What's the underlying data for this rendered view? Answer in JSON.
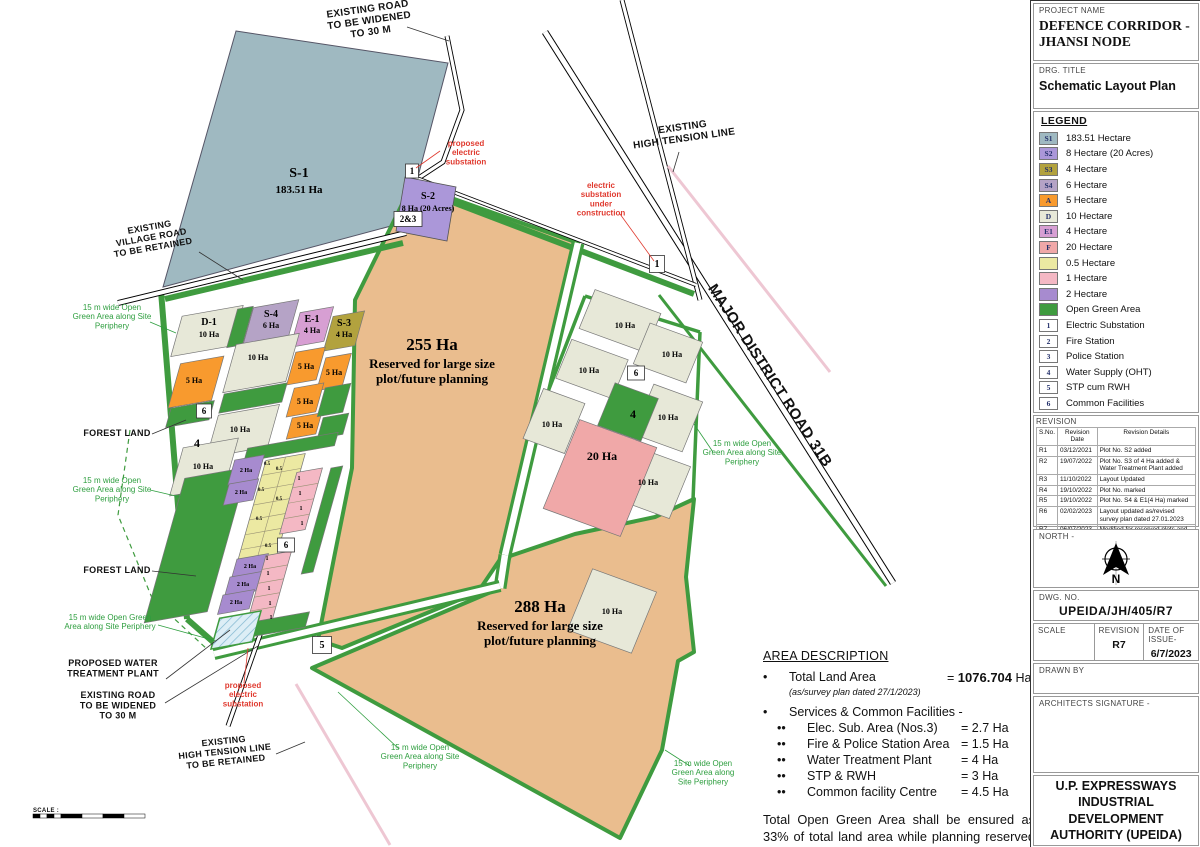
{
  "title_block": {
    "project_name_label": "PROJECT NAME",
    "project_name": "DEFENCE CORRIDOR -\nJHANSI NODE",
    "drg_title_label": "DRG. TITLE",
    "drg_title": "Schematic Layout Plan",
    "legend": {
      "heading": "LEGEND",
      "items": [
        {
          "key": "S1",
          "color": "#9fb9c1",
          "label": "183.51 Hectare",
          "type": "swatch"
        },
        {
          "key": "S2",
          "color": "#ab97d9",
          "label": "8 Hectare (20 Acres)",
          "type": "swatch"
        },
        {
          "key": "S3",
          "color": "#b2a23e",
          "label": "4 Hectare",
          "type": "swatch"
        },
        {
          "key": "S4",
          "color": "#b5a3c6",
          "label": "6 Hectare",
          "type": "swatch"
        },
        {
          "key": "A",
          "color": "#f89a2e",
          "label": "5 Hectare",
          "type": "swatch"
        },
        {
          "key": "D",
          "color": "#e7e8d8",
          "label": "10 Hectare",
          "type": "swatch"
        },
        {
          "key": "E1",
          "color": "#d79fd3",
          "label": "4 Hectare",
          "type": "swatch"
        },
        {
          "key": "F",
          "color": "#f0a8a8",
          "label": "20 Hectare",
          "type": "swatch"
        },
        {
          "key": "",
          "color": "#ece9a2",
          "label": "0.5 Hectare",
          "type": "swatch"
        },
        {
          "key": "",
          "color": "#f4b8c4",
          "label": "1 Hectare",
          "type": "swatch"
        },
        {
          "key": "",
          "color": "#a78bcf",
          "label": "2 Hectare",
          "type": "swatch"
        },
        {
          "key": "",
          "color": "#3f9b3f",
          "label": "Open Green Area",
          "type": "swatch"
        },
        {
          "key": "1",
          "color": "",
          "label": "Electric Substation",
          "type": "numbox"
        },
        {
          "key": "2",
          "color": "",
          "label": "Fire Station",
          "type": "numbox"
        },
        {
          "key": "3",
          "color": "",
          "label": "Police Station",
          "type": "numbox"
        },
        {
          "key": "4",
          "color": "",
          "label": "Water Supply (OHT)",
          "type": "numbox"
        },
        {
          "key": "5",
          "color": "",
          "label": "STP cum RWH",
          "type": "numbox"
        },
        {
          "key": "6",
          "color": "",
          "label": "Common Facilities",
          "type": "numbox"
        }
      ]
    },
    "revision": {
      "heading": "REVISION",
      "columns": [
        "S.No.",
        "Revision Date",
        "Revision Details"
      ],
      "rows": [
        [
          "R1",
          "03/12/2021",
          "Plot No. S2 added"
        ],
        [
          "R2",
          "19/07/2022",
          "Plot No. S3 of 4 Ha added & Water Treatment Plant added"
        ],
        [
          "R3",
          "11/10/2022",
          "Layout Updated"
        ],
        [
          "R4",
          "19/10/2022",
          "Plot No. marked"
        ],
        [
          "R5",
          "19/10/2022",
          "Plot No. S4 & E1(4 Ha) marked"
        ],
        [
          "R6",
          "02/02/2023",
          "Layout updated as/revised survey plan dated 27.01.2023"
        ],
        [
          "R7",
          "06/07/2023",
          "Modified for reserved plots and addition of plots of 0.5 Ha, 1 Ha, 2 Ha & 5 Ha"
        ]
      ]
    },
    "north_label": "NORTH -",
    "north_letter": "N",
    "dwg_no_label": "DWG. NO.",
    "dwg_no": "UPEIDA/JH/405/R7",
    "scale_label": "SCALE",
    "revision_label": "REVISION",
    "revision_value": "R7",
    "date_label": "DATE OF ISSUE-",
    "date_value": "6/7/2023",
    "drawn_by_label": "DRAWN BY",
    "architects_label": "ARCHITECTS SIGNATURE -",
    "authority": "U.P. EXPRESSWAYS\nINDUSTRIAL DEVELOPMENT\nAUTHORITY (UPEIDA)"
  },
  "area_description": {
    "heading": "AREA DESCRIPTION",
    "bullet": "•",
    "sub_bullet": "••",
    "total_label": "Total Land Area",
    "total_eq": "= ",
    "total_value": "1076.704",
    "total_unit": " Ha",
    "total_note": "(as/survey plan dated 27/1/2023)",
    "services_heading": "Services & Common Facilities -",
    "services": [
      {
        "label": "Elec. Sub. Area (Nos.3)",
        "value": "= 2.7 Ha"
      },
      {
        "label": "Fire & Police Station Area",
        "value": "= 1.5 Ha"
      },
      {
        "label": "Water Treatment Plant",
        "value": "= 4 Ha"
      },
      {
        "label": "STP & RWH",
        "value": "= 3 Ha"
      },
      {
        "label": "Common facility Centre",
        "value": "= 4.5 Ha"
      }
    ],
    "note": "Total Open Green Area shall be ensured as 33% of total land area while planning reserved area for large plots."
  },
  "map": {
    "labels": [
      {
        "n": "existing-road-top-note",
        "c": "ann",
        "fs": 10,
        "x": 368,
        "y": 12,
        "r": -8,
        "t": "EXISTING ROAD\nTO BE WIDENED\nTO 30 M"
      },
      {
        "n": "existing-village-road-note",
        "c": "ann",
        "fs": 9,
        "x": 150,
        "y": 230,
        "r": -10,
        "t": "EXISTING\nVILLAGE ROAD\nTO BE RETAINED"
      },
      {
        "n": "existing-ht-line-top-note",
        "c": "ann",
        "fs": 10,
        "x": 683,
        "y": 130,
        "r": -8,
        "t": "EXISTING\nHIGH TENSION LINE"
      },
      {
        "n": "mdr-31b-label",
        "c": "ann",
        "fs": 15,
        "x": 766,
        "y": 378,
        "r": 57,
        "ls": 3,
        "t": "MAJOR DISTRICT ROAD 31B"
      },
      {
        "n": "forest-land-1",
        "c": "ann",
        "fs": 9,
        "x": 117,
        "y": 436,
        "t": "FOREST LAND"
      },
      {
        "n": "forest-land-2",
        "c": "ann",
        "fs": 9,
        "x": 117,
        "y": 573,
        "t": "FOREST LAND"
      },
      {
        "n": "proposed-wtp-note",
        "c": "ann",
        "fs": 9,
        "x": 113,
        "y": 666,
        "t": "PROPOSED WATER\nTREATMENT PLANT"
      },
      {
        "n": "existing-road-bottom-note",
        "c": "ann",
        "fs": 9,
        "x": 118,
        "y": 698,
        "t": "EXISTING ROAD\nTO BE WIDENED\nTO 30 M"
      },
      {
        "n": "existing-ht-line-bottom-note",
        "c": "ann",
        "fs": 9,
        "x": 224,
        "y": 744,
        "r": -6,
        "t": "EXISTING\nHIGH TENSION LINE\nTO BE RETAINED"
      },
      {
        "n": "green-note-1",
        "c": "grn",
        "fs": 8,
        "x": 112,
        "y": 310,
        "t": "15 m wide Open\nGreen Area along Site\nPeriphery"
      },
      {
        "n": "green-note-2",
        "c": "grn",
        "fs": 8,
        "x": 112,
        "y": 483,
        "t": "15 m wide Open\nGreen Area along Site\nPeriphery"
      },
      {
        "n": "green-note-3",
        "c": "grn",
        "fs": 8,
        "x": 110,
        "y": 620,
        "t": "15 m wide Open Green\nArea along Site Periphery"
      },
      {
        "n": "green-note-4",
        "c": "grn",
        "fs": 8,
        "x": 742,
        "y": 446,
        "t": "15 m wide Open\nGreen Area along Site\nPeriphery"
      },
      {
        "n": "green-note-5",
        "c": "grn",
        "fs": 8,
        "x": 420,
        "y": 750,
        "t": "15 m wide Open\nGreen Area along Site\nPeriphery"
      },
      {
        "n": "green-note-6",
        "c": "grn",
        "fs": 8,
        "x": 703,
        "y": 766,
        "t": "15 m wide Open\nGreen Area along\nSite Periphery"
      },
      {
        "n": "red-note-proposed-substation-top",
        "c": "red",
        "fs": 8,
        "x": 466,
        "y": 146,
        "t": "proposed\nelectric\nsubstation"
      },
      {
        "n": "red-note-substation-construction",
        "c": "red",
        "fs": 8,
        "x": 601,
        "y": 188,
        "t": "electric\nsubstation\nunder\nconstruction"
      },
      {
        "n": "red-note-proposed-substation-bottom",
        "c": "red",
        "fs": 8,
        "x": 243,
        "y": 688,
        "t": "proposed\nelectric\nsubstation"
      },
      {
        "n": "plot-s1-code",
        "c": "ser",
        "fs": 14,
        "x": 299,
        "y": 177,
        "t": "S-1"
      },
      {
        "n": "plot-s1-area",
        "c": "ser",
        "fs": 11,
        "x": 299,
        "y": 193,
        "t": "183.51 Ha"
      },
      {
        "n": "plot-s2-code",
        "c": "ser",
        "fs": 10,
        "x": 428,
        "y": 199,
        "t": "S-2"
      },
      {
        "n": "plot-s2-area",
        "c": "ser",
        "fs": 8,
        "x": 428,
        "y": 211,
        "t": "8 Ha (20 Acres)"
      },
      {
        "n": "reserved-255",
        "c": "ser",
        "fs": 17,
        "x": 432,
        "y": 350,
        "t": "255 Ha"
      },
      {
        "n": "reserved-255-note",
        "c": "ser",
        "fs": 13,
        "x": 432,
        "y": 368,
        "t": "Reserved for large size\nplot/future planning"
      },
      {
        "n": "reserved-288",
        "c": "ser",
        "fs": 17,
        "x": 540,
        "y": 612,
        "t": "288 Ha"
      },
      {
        "n": "reserved-288-note",
        "c": "ser",
        "fs": 13,
        "x": 540,
        "y": 630,
        "t": "Reserved for large size\nplot/future planning"
      },
      {
        "n": "plot-d1-code",
        "c": "ser",
        "fs": 10,
        "x": 209,
        "y": 325,
        "t": "D-1"
      },
      {
        "n": "plot-d1-area",
        "c": "ser",
        "fs": 8,
        "x": 209,
        "y": 337,
        "t": "10 Ha"
      },
      {
        "n": "plot-s4-code",
        "c": "ser",
        "fs": 10,
        "x": 271,
        "y": 317,
        "t": "S-4"
      },
      {
        "n": "plot-s4-area",
        "c": "ser",
        "fs": 8,
        "x": 271,
        "y": 328,
        "t": "6 Ha"
      },
      {
        "n": "plot-e1-code",
        "c": "ser",
        "fs": 10,
        "x": 312,
        "y": 322,
        "t": "E-1"
      },
      {
        "n": "plot-e1-area",
        "c": "ser",
        "fs": 8,
        "x": 312,
        "y": 333,
        "t": "4 Ha"
      },
      {
        "n": "plot-s3-code",
        "c": "ser",
        "fs": 10,
        "x": 344,
        "y": 326,
        "t": "S-3"
      },
      {
        "n": "plot-s3-area",
        "c": "ser",
        "fs": 8,
        "x": 344,
        "y": 337,
        "t": "4 Ha"
      },
      {
        "n": "plot-10ha",
        "c": "ser",
        "fs": 8,
        "x": 258,
        "y": 360,
        "t": "10 Ha"
      },
      {
        "n": "plot-10ha",
        "c": "ser",
        "fs": 8,
        "x": 240,
        "y": 432,
        "t": "10 Ha"
      },
      {
        "n": "plot-10ha",
        "c": "ser",
        "fs": 8,
        "x": 203,
        "y": 469,
        "t": "10 Ha"
      },
      {
        "n": "plot-5ha",
        "c": "ser",
        "fs": 8,
        "x": 194,
        "y": 383,
        "t": "5 Ha"
      },
      {
        "n": "plot-5ha",
        "c": "ser",
        "fs": 8,
        "x": 306,
        "y": 369,
        "t": "5 Ha"
      },
      {
        "n": "plot-5ha",
        "c": "ser",
        "fs": 8,
        "x": 334,
        "y": 375,
        "t": "5 Ha"
      },
      {
        "n": "plot-5ha",
        "c": "ser",
        "fs": 8,
        "x": 305,
        "y": 404,
        "t": "5 Ha"
      },
      {
        "n": "plot-5ha",
        "c": "ser",
        "fs": 8,
        "x": 305,
        "y": 428,
        "t": "5 Ha"
      },
      {
        "n": "facility-4-left",
        "c": "ser",
        "fs": 12,
        "x": 197,
        "y": 447,
        "t": "4"
      },
      {
        "n": "plot-10ha",
        "c": "ser",
        "fs": 8,
        "x": 625,
        "y": 328,
        "t": "10 Ha"
      },
      {
        "n": "plot-10ha",
        "c": "ser",
        "fs": 8,
        "x": 672,
        "y": 357,
        "t": "10 Ha"
      },
      {
        "n": "plot-10ha",
        "c": "ser",
        "fs": 8,
        "x": 589,
        "y": 373,
        "t": "10 Ha"
      },
      {
        "n": "plot-10ha",
        "c": "ser",
        "fs": 8,
        "x": 552,
        "y": 427,
        "t": "10 Ha"
      },
      {
        "n": "plot-10ha",
        "c": "ser",
        "fs": 8,
        "x": 668,
        "y": 420,
        "t": "10 Ha"
      },
      {
        "n": "plot-10ha",
        "c": "ser",
        "fs": 8,
        "x": 648,
        "y": 485,
        "t": "10 Ha"
      },
      {
        "n": "plot-10ha",
        "c": "ser",
        "fs": 8,
        "x": 612,
        "y": 614,
        "t": "10 Ha"
      },
      {
        "n": "plot-20ha",
        "c": "ser",
        "fs": 12,
        "x": 602,
        "y": 460,
        "t": "20 Ha"
      },
      {
        "n": "facility-4-right",
        "c": "ser",
        "fs": 12,
        "x": 633,
        "y": 418,
        "t": "4"
      },
      {
        "n": "plot-2ha",
        "c": "ser",
        "fs": 6,
        "x": 246,
        "y": 472,
        "t": "2 Ha"
      },
      {
        "n": "plot-2ha",
        "c": "ser",
        "fs": 6,
        "x": 241,
        "y": 494,
        "t": "2 Ha"
      },
      {
        "n": "plot-2ha",
        "c": "ser",
        "fs": 6,
        "x": 250,
        "y": 568,
        "t": "2 Ha"
      },
      {
        "n": "plot-2ha",
        "c": "ser",
        "fs": 6,
        "x": 243,
        "y": 586,
        "t": "2 Ha"
      },
      {
        "n": "plot-2ha",
        "c": "ser",
        "fs": 6,
        "x": 236,
        "y": 604,
        "t": "2 Ha"
      },
      {
        "n": "plot-05ha",
        "c": "ser",
        "fs": 5,
        "x": 267,
        "y": 465,
        "t": "0.5"
      },
      {
        "n": "plot-05ha",
        "c": "ser",
        "fs": 5,
        "x": 279,
        "y": 470,
        "t": "0.5"
      },
      {
        "n": "plot-05ha",
        "c": "ser",
        "fs": 5,
        "x": 261,
        "y": 491,
        "t": "0.5"
      },
      {
        "n": "plot-05ha",
        "c": "ser",
        "fs": 5,
        "x": 279,
        "y": 500,
        "t": "0.5"
      },
      {
        "n": "plot-05ha",
        "c": "ser",
        "fs": 5,
        "x": 259,
        "y": 520,
        "t": "0.5"
      },
      {
        "n": "plot-05ha",
        "c": "ser",
        "fs": 5,
        "x": 268,
        "y": 547,
        "t": "0.5"
      },
      {
        "n": "plot-1ha",
        "c": "ser",
        "fs": 6,
        "x": 299,
        "y": 480,
        "t": "1"
      },
      {
        "n": "plot-1ha",
        "c": "ser",
        "fs": 6,
        "x": 300,
        "y": 495,
        "t": "1"
      },
      {
        "n": "plot-1ha",
        "c": "ser",
        "fs": 6,
        "x": 301,
        "y": 510,
        "t": "1"
      },
      {
        "n": "plot-1ha",
        "c": "ser",
        "fs": 6,
        "x": 302,
        "y": 525,
        "t": "1"
      },
      {
        "n": "plot-1ha",
        "c": "ser",
        "fs": 6,
        "x": 267,
        "y": 560,
        "t": "1"
      },
      {
        "n": "plot-1ha",
        "c": "ser",
        "fs": 6,
        "x": 268,
        "y": 575,
        "t": "1"
      },
      {
        "n": "plot-1ha",
        "c": "ser",
        "fs": 6,
        "x": 269,
        "y": 590,
        "t": "1"
      },
      {
        "n": "plot-1ha",
        "c": "ser",
        "fs": 6,
        "x": 270,
        "y": 605,
        "t": "1"
      },
      {
        "n": "plot-1ha",
        "c": "ser",
        "fs": 6,
        "x": 271,
        "y": 619,
        "t": "1"
      },
      {
        "n": "scale-bar-label",
        "c": "ann",
        "fs": 6,
        "x": 33,
        "y": 812,
        "an": "start",
        "t": "SCALE :"
      }
    ],
    "numboxes": [
      {
        "t": "1",
        "x": 412,
        "y": 171,
        "w": 13,
        "h": 14
      },
      {
        "t": "2&3",
        "x": 408,
        "y": 219,
        "w": 28,
        "h": 15
      },
      {
        "t": "1",
        "x": 657,
        "y": 264,
        "w": 15,
        "h": 17
      },
      {
        "t": "6",
        "x": 204,
        "y": 411,
        "w": 15,
        "h": 14
      },
      {
        "t": "6",
        "x": 286,
        "y": 545,
        "w": 17,
        "h": 14
      },
      {
        "t": "6",
        "x": 636,
        "y": 373,
        "w": 17,
        "h": 14
      },
      {
        "t": "5",
        "x": 322,
        "y": 645,
        "w": 19,
        "h": 17
      }
    ]
  }
}
